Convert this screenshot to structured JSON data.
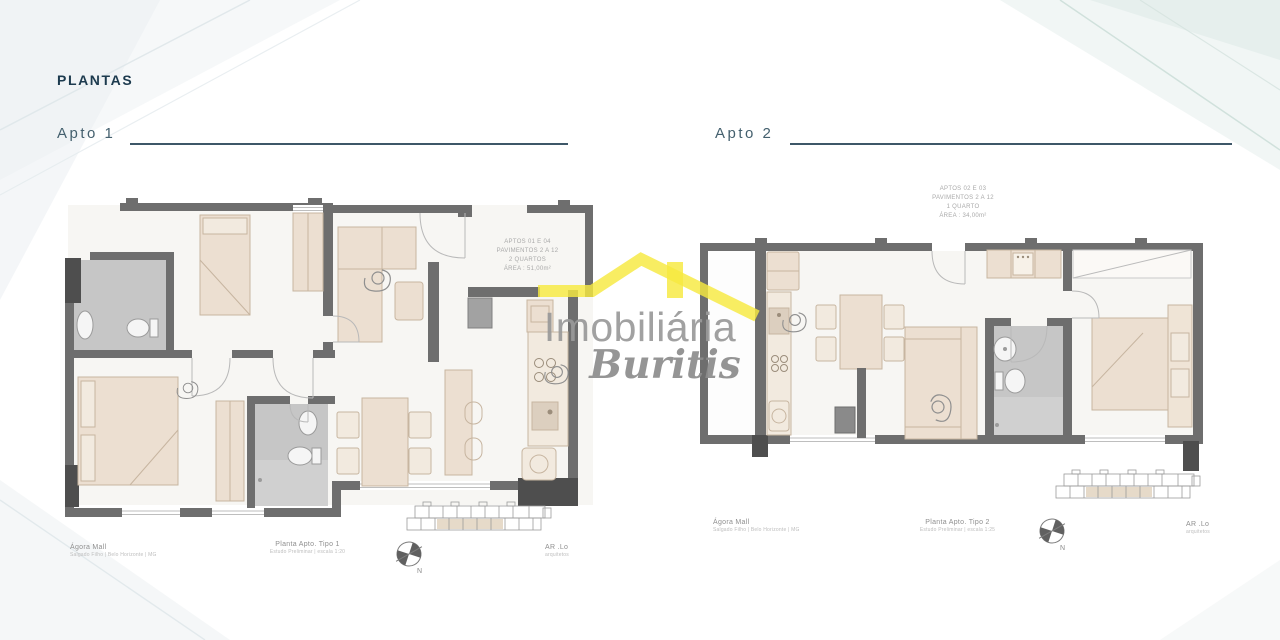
{
  "header": {
    "title": "PLANTAS"
  },
  "logo": {
    "name": "Imobiliária",
    "script": "Buritis"
  },
  "compass_n": "N",
  "plan1": {
    "label": "Apto 1",
    "annotation": {
      "l1": "APTOS 01 E 04",
      "l2": "PAVIMENTOS 2 A 12",
      "l3": "2 QUARTOS",
      "l4": "ÁREA : 51,00m²"
    },
    "captions": {
      "project": "Ágora Mall",
      "project_sub": "Salgado Filho | Belo Horizonte | MG",
      "plan": "Planta Apto. Tipo 1",
      "plan_sub": "Estudo Preliminar | escala 1:20",
      "firm": "AR .Lo",
      "firm_sub": "arquitetos"
    }
  },
  "plan2": {
    "label": "Apto 2",
    "annotation": {
      "l1": "APTOS 02 E 03",
      "l2": "PAVIMENTOS 2 A 12",
      "l3": "1 QUARTO",
      "l4": "ÁREA : 34,00m²"
    },
    "captions": {
      "project": "Ágora Mall",
      "project_sub": "Salgado Filho | Belo Horizonte | MG",
      "plan": "Planta Apto. Tipo 2",
      "plan_sub": "Estudo Preliminar | escala 1:25",
      "firm": "AR .Lo",
      "firm_sub": "arquitetos"
    }
  },
  "colors": {
    "accent": "#1c3a4e",
    "label": "#44606e",
    "wall": "#6e6e6e",
    "walldark": "#4e4e4e",
    "furn": "#ecdfd1",
    "furnstroke": "#c7b5a0",
    "furnlight": "#f2eadf",
    "bath": "#c6c6c6",
    "bathlight": "#d0d0d0",
    "floor": "#f7f6f3",
    "lineart": "#9b9b9b",
    "arc": "#b9b9b9",
    "logoyellow": "#f6e93f",
    "logogray": "#9a9a9a"
  }
}
